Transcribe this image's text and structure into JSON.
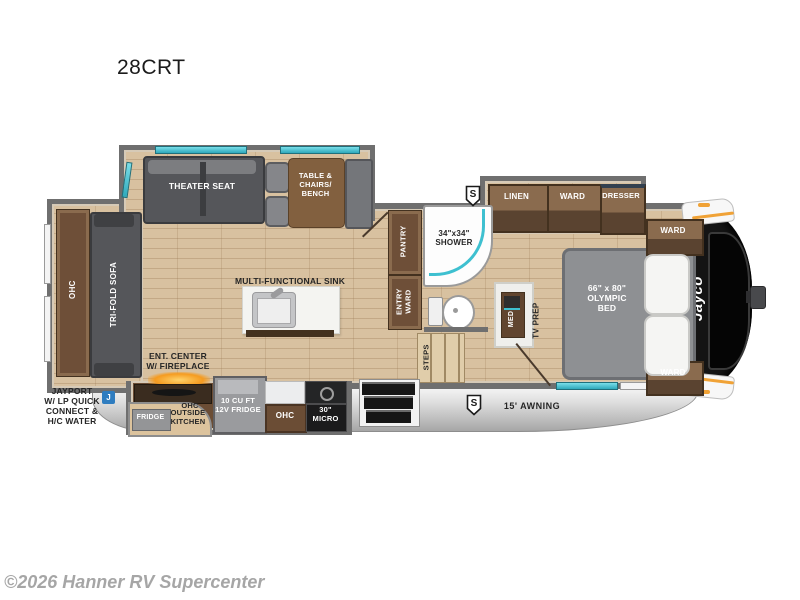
{
  "page": {
    "title": "28CRT",
    "copyright": "©2026 Hanner RV Supercenter"
  },
  "colors": {
    "wall_gray": "#6f6f6f",
    "floor_wood": "#d8c1a0",
    "cabinet_brown": "#6e4f38",
    "accent_teal": "#3fc0d1",
    "accent_orange": "#f0a236",
    "cap_black": "#141414",
    "badge_blue": "#2f7dc0",
    "skirt_silver": "#c9c9c9",
    "label_dark": "#262626"
  },
  "plan": {
    "rear_slide": {
      "ohc": "OHC",
      "sofa": "TRI-FOLD SOFA"
    },
    "living_slide": {
      "theater_seat": "THEATER SEAT",
      "dinette": "TABLE &\nCHAIRS/\nBENCH"
    },
    "kitchen": {
      "island_label": "MULTI-FUNCTIONAL SINK",
      "ent_center": "ENT. CENTER\nW/ FIREPLACE",
      "ohc_outside": "OHC",
      "outside_fridge": "FRIDGE",
      "outside_kitchen": "OUTSIDE\nKITCHEN",
      "fridge": "10 CU FT\n12V FRIDGE",
      "ohc": "OHC",
      "micro": "30\"\nMICRO"
    },
    "bath": {
      "pantry": "PANTRY",
      "entry_ward": "ENTRY\nWARD",
      "shower": "34\"x34\"\nSHOWER",
      "steps": "STEPS"
    },
    "bedroom": {
      "linen": "LINEN",
      "ward_slide": "WARD",
      "dresser": "DRESSER",
      "ward_front_top": "WARD",
      "ward_front_bottom": "WARD",
      "bed": "66\" x 80\"\nOLYMPIC\nBED",
      "med": "MED",
      "tv_prep": "TV PREP"
    },
    "exterior": {
      "jayport": "JAYPORT\nW/ LP QUICK\nCONNECT &\nH/C WATER",
      "awning": "15' AWNING",
      "brand_logo": "Jayco",
      "solar_badge": "S",
      "jayport_badge": "J"
    }
  }
}
